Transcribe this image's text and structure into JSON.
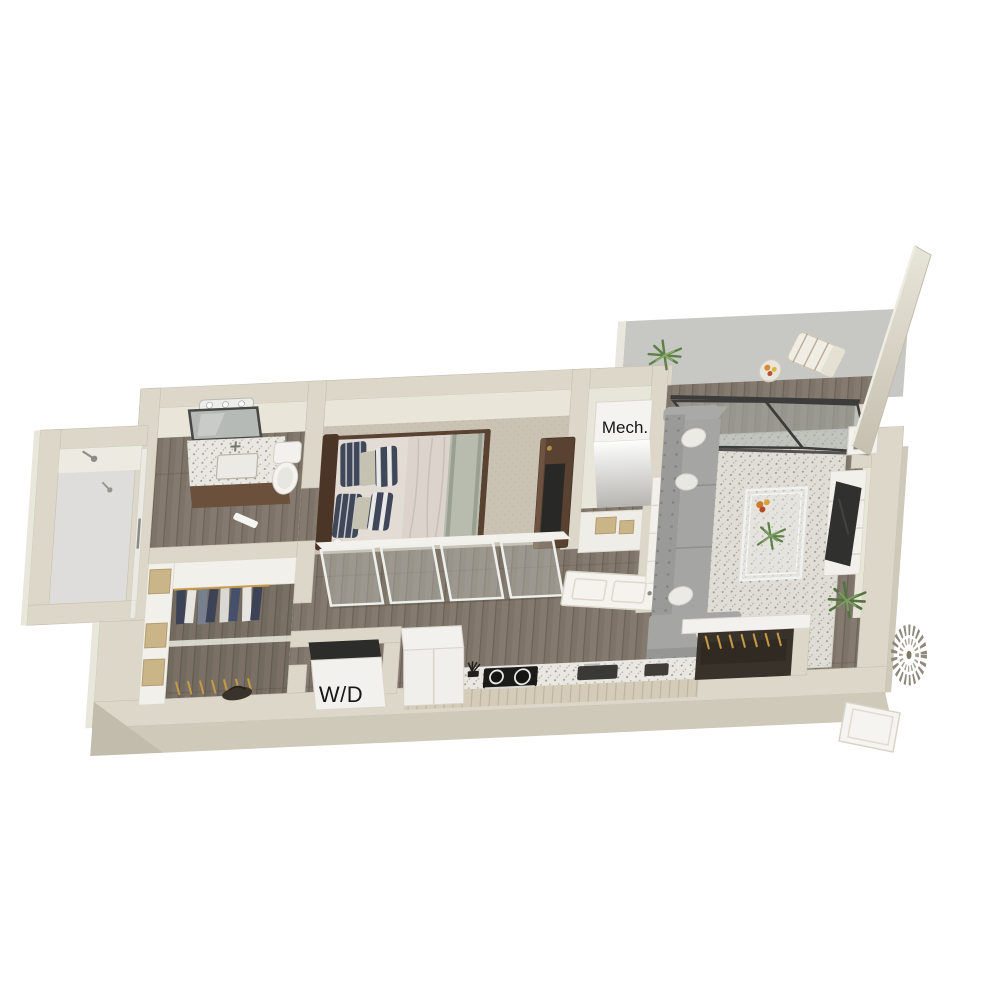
{
  "scene": {
    "type": "3d-floor-plan-rendering",
    "view": "isometric-top-down",
    "background": "#ffffff",
    "unit": "one-bedroom-apartment"
  },
  "labels": {
    "mechanical_closet": "Mech.",
    "washer_dryer": "W/D"
  },
  "colors": {
    "wall_top": "#dcd7c9",
    "wall_face_light": "#e9e5d9",
    "wall_outer": "#cfc9ba",
    "wood_floor": "#7d7368",
    "wood_gap": "#5f564c",
    "carpet": "#cac3b3",
    "tile_shower": "#dedddb",
    "balcony_concrete": "#c7c7c4",
    "frame_dark": "#3c3c3a",
    "sofa_gray": "#a5a5a3",
    "rug_base": "#e0ddd6",
    "counter_speckle": "#e9e7e1",
    "cabinet_beige": "#d4ccb8",
    "appliance_white": "#f2f1ee",
    "walnut": "#5a4232",
    "navy": "#3f4759",
    "linen": "#e2dcd5",
    "sage": "#b7bcae",
    "tan_box": "#c9b588",
    "gold": "#c49a45",
    "mech_white": "#f4f3f0",
    "plant_green": "#5e8148",
    "label_ink": "#161616"
  },
  "rooms": [
    {
      "name": "bathroom",
      "features": [
        "vanity-sink",
        "mirror",
        "vanity-light",
        "toilet",
        "walk-in-shower"
      ]
    },
    {
      "name": "walk-in-closet",
      "features": [
        "shelving",
        "hanging-clothes",
        "storage-boxes",
        "duffel-bag"
      ]
    },
    {
      "name": "bedroom",
      "features": [
        "bed",
        "striped-pillows",
        "media-console",
        "tv",
        "glass-partition"
      ]
    },
    {
      "name": "mechanical-closet",
      "features": [
        "mechanical-unit",
        "storage-niche",
        "paneled-door"
      ]
    },
    {
      "name": "living-room",
      "features": [
        "sectional-sofa",
        "area-rug",
        "glass-coffee-table",
        "tv-console",
        "tv",
        "wall-cube-shelf",
        "potted-plants",
        "sliding-glass-door"
      ]
    },
    {
      "name": "kitchen",
      "features": [
        "refrigerator",
        "range",
        "sink",
        "countertop",
        "cabinets"
      ]
    },
    {
      "name": "laundry-closet",
      "features": [
        "washer-dryer-unit"
      ]
    },
    {
      "name": "entry",
      "features": [
        "coat-closet",
        "entry-door",
        "wall-wreath"
      ]
    },
    {
      "name": "balcony",
      "features": [
        "lounge-chair",
        "side-table",
        "fruit-bowl",
        "potted-plant",
        "tall-privacy-wall"
      ]
    }
  ]
}
